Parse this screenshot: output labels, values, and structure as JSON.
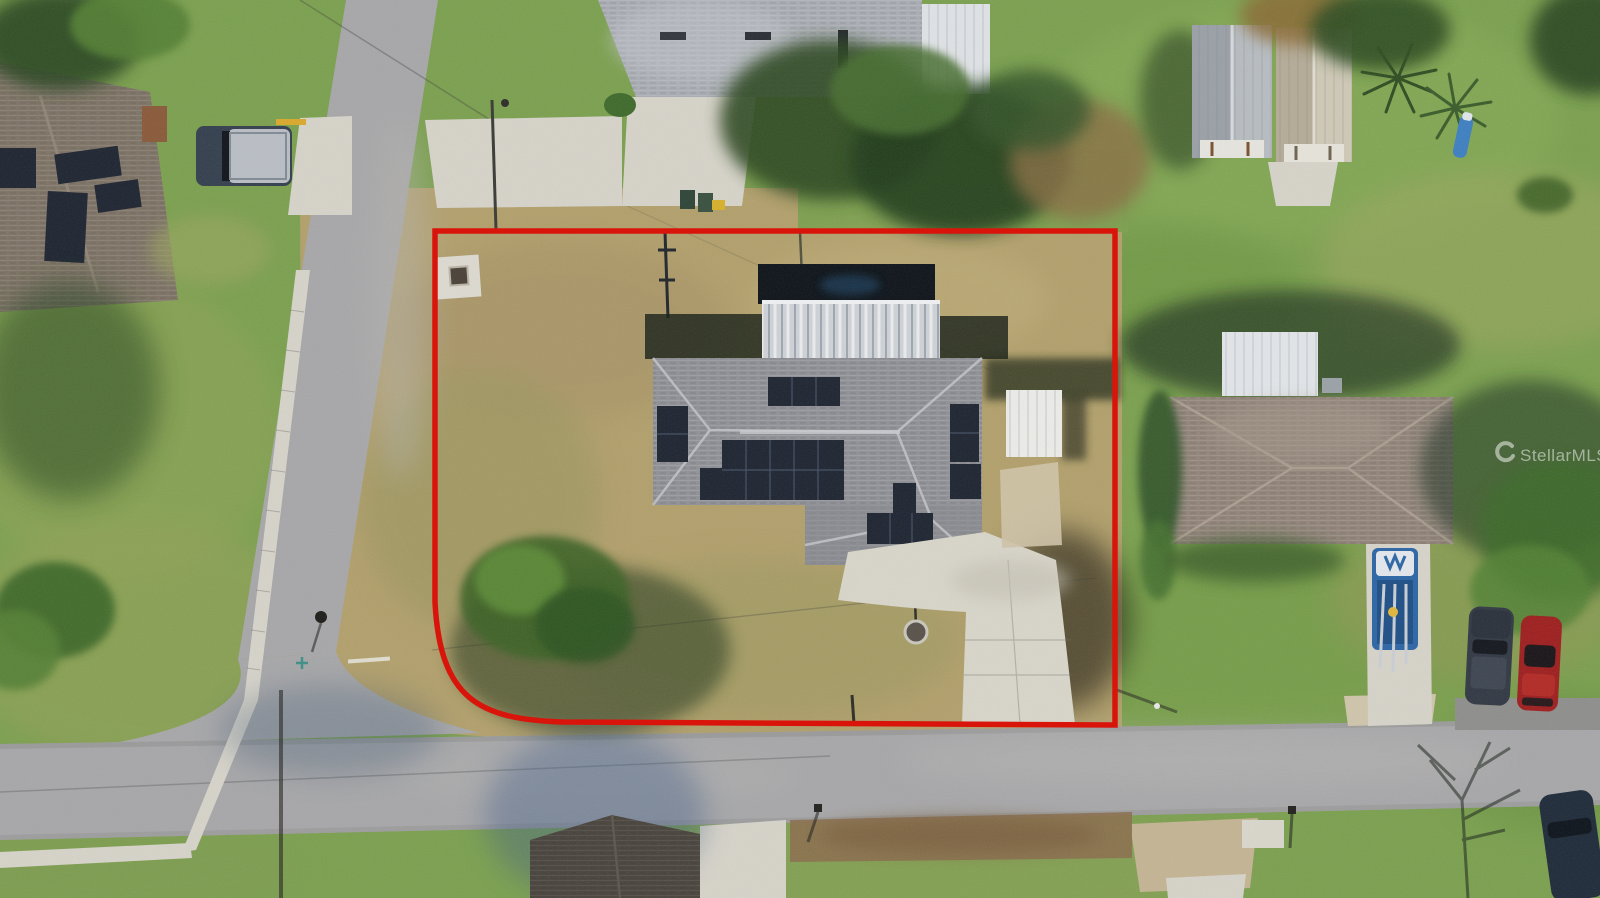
{
  "watermark": {
    "text": "StellarMLS",
    "logo_icon": "stellar-swirl-icon",
    "color": "#ffffff",
    "opacity": 0.5
  },
  "boundary": {
    "color": "#d9150b",
    "stroke_width": 5.5,
    "shape": "rectangle-with-rounded-bottom-left-corner"
  },
  "palette": {
    "grass_green": "#7ba04f",
    "grass_dark": "#5d8a3e",
    "grass_dry": "#b2a06c",
    "grass_olive": "#8e9657",
    "road_gray": "#a7a7a9",
    "concrete": "#d6d3c9",
    "roof_main": "#8f9196",
    "roof_north": "#a9adb3",
    "roof_east": "#92857a",
    "roof_south": "#49443d",
    "solar_panel": "#1e2531",
    "metal_silver": "#ced2d7",
    "white_structure": "#ebebe7",
    "shadow_green": "#1d3320",
    "boundary_red": "#d9150b",
    "watermark_white": "#ffffff",
    "truck_blue": "#2c66a5",
    "car_red": "#9e1f1f",
    "suv_gray": "#323944"
  },
  "scene_objects": {
    "subject_lot": "corner-lot-outlined-in-red",
    "subject_house": "gray-hip-roof-house-with-solar-panels",
    "rear_structure": "silver-metal-enclosure",
    "side_structure": "white-shed",
    "vehicles": [
      "pickup-truck",
      "blue-work-truck-with-ladders",
      "dark-suv",
      "red-car",
      "dark-suv-corner"
    ],
    "outbuildings": [
      "metal-shed-1",
      "metal-shed-2"
    ],
    "roads": [
      "north-south-street",
      "east-west-street"
    ]
  }
}
